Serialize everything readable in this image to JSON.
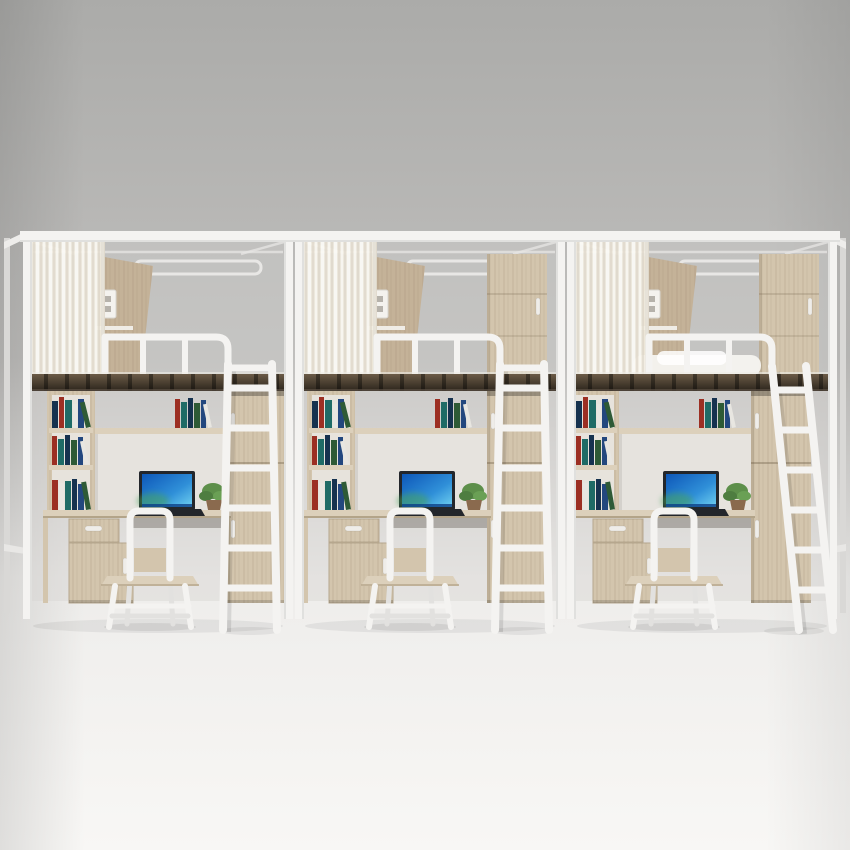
{
  "scene": {
    "type": "product-photo",
    "subject": "triple-loft-bunk-bed-with-desk-set",
    "units_count": 3
  },
  "colors": {
    "bg_top": "#ababa9",
    "bg_mid": "#c0bfbd",
    "bg_floor": "#eeedeb",
    "bg_bottom": "#f8f7f5",
    "frame": "#f4f3f1",
    "frame_dim": "#e2e1df",
    "frame_shadow": "#cfcecc",
    "wood": "#d3c5ad",
    "wood_hi": "#dcd0bb",
    "wood_dk": "#c4b298",
    "wood_edge": "#a6957a",
    "shelf_back": "#e7e3dc",
    "hutch_back": "#e6e3de",
    "deck_top": "#6b5b47",
    "deck_bottom": "#2c251c",
    "curtain": "#f1ece1",
    "handle": "#efede9",
    "screen_a": "#0d57b8",
    "screen_b": "#6fd0f0",
    "screen_glow": "#46a35c",
    "plant_a": "#5d8f4a",
    "plant_b": "#4e7d40",
    "plant_c": "#6aa055",
    "pot": "#8a6a4e"
  },
  "book_colors": [
    "#16324f",
    "#9c2f23",
    "#1f6b66",
    "#e8e6e1",
    "#23477e",
    "#2e5a36"
  ],
  "units": [
    {
      "id": "left",
      "x": 23,
      "furniture_dx": 12,
      "ladder": "front",
      "has_bedding": false,
      "has_upper_locker": false
    },
    {
      "id": "middle",
      "x": 295,
      "furniture_dx": 0,
      "ladder": "front",
      "has_bedding": false,
      "has_upper_locker": true
    },
    {
      "id": "right",
      "x": 567,
      "furniture_dx": -8,
      "ladder": "lean",
      "has_bedding": true,
      "has_upper_locker": true
    }
  ],
  "unit_components": [
    "loft-bed-frame",
    "privacy-curtain",
    "guardrail",
    "bed-deck",
    "power-outlet",
    "bedside-shelf",
    "headboard-panel",
    "bookshelf",
    "hutch-shelf",
    "books",
    "desk",
    "drawer",
    "pedestal-cabinet",
    "laptop",
    "potted-plant",
    "chair",
    "wardrobe",
    "ladder"
  ]
}
